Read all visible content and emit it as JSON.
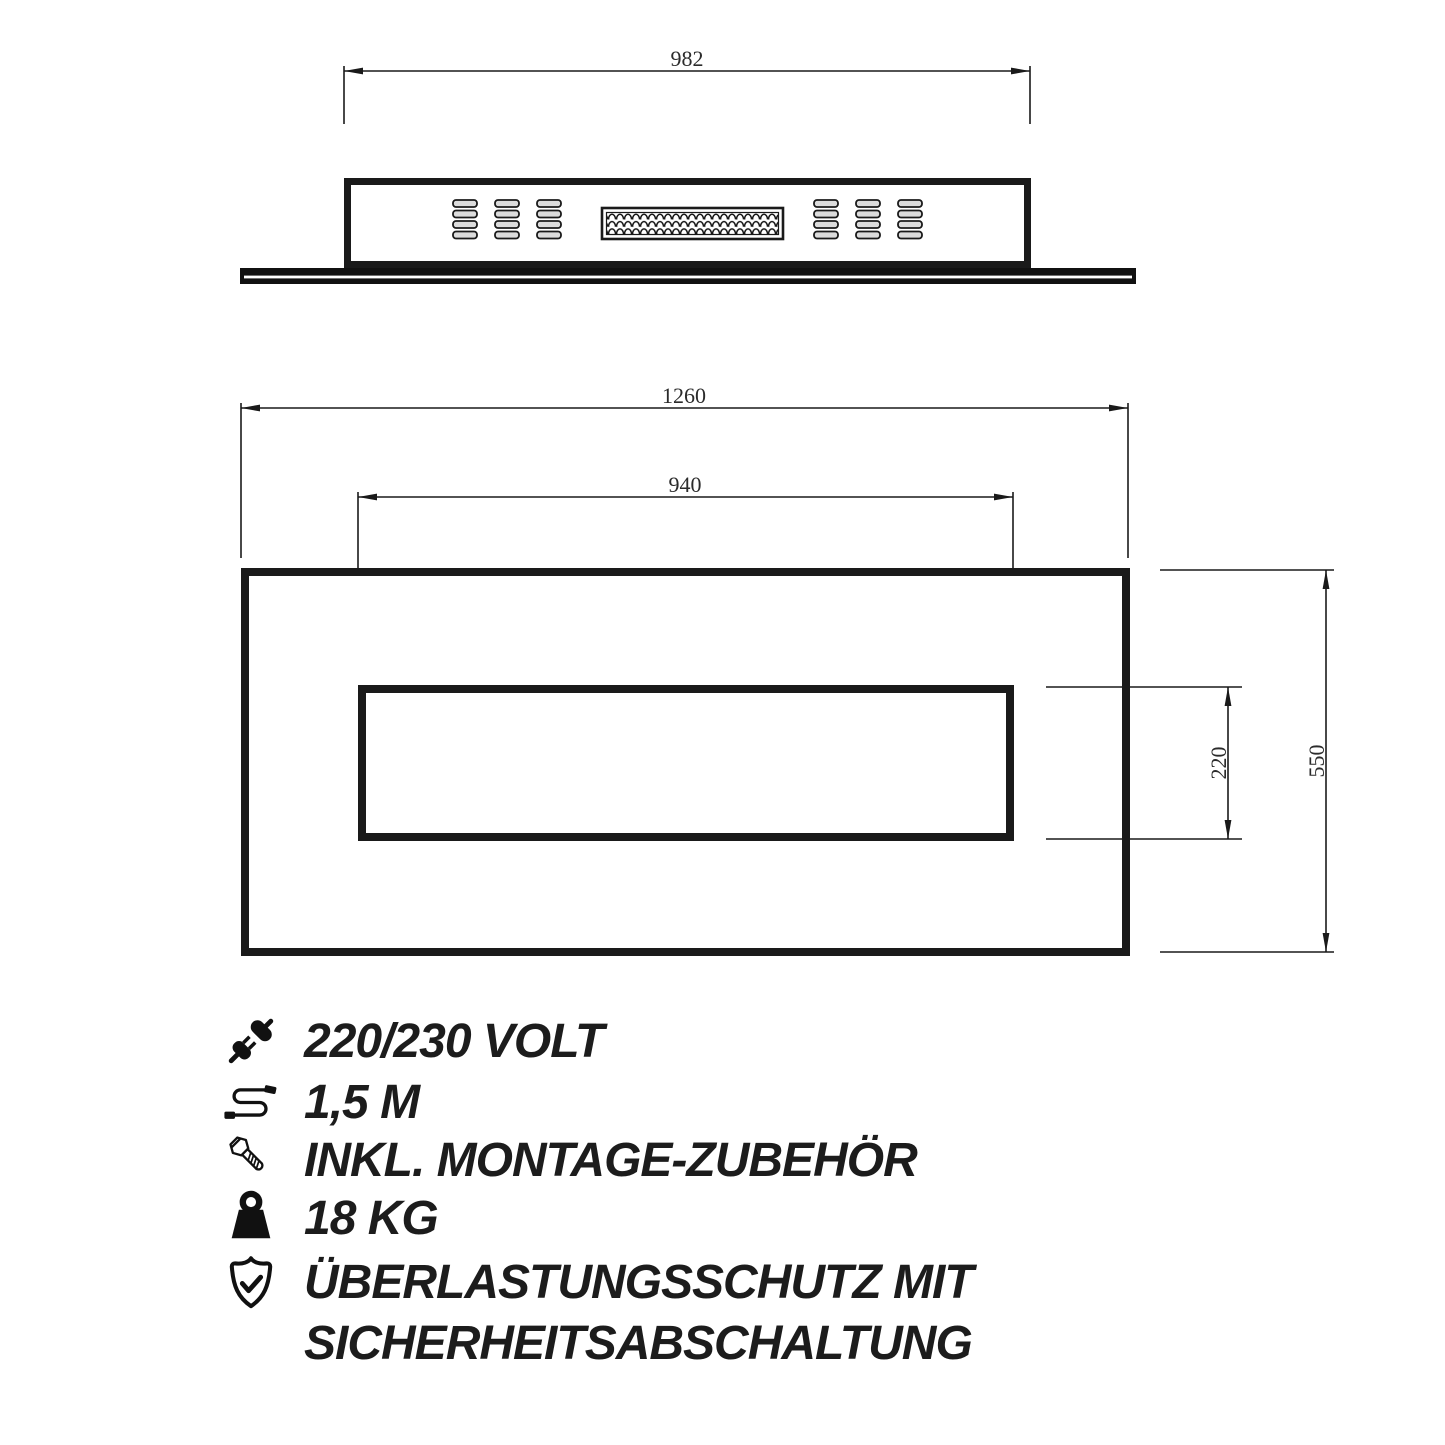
{
  "drawing": {
    "top_view": {
      "width_label": "982"
    },
    "front_view": {
      "outer_width_label": "1260",
      "inner_width_label": "940",
      "inner_height_label": "220",
      "outer_height_label": "550"
    }
  },
  "specs": {
    "items": [
      {
        "icon": "power-plug-icon",
        "label": "220/230 VOLT"
      },
      {
        "icon": "cable-icon",
        "label": "1,5 M"
      },
      {
        "icon": "screw-icon",
        "label": "INKL. MONTAGE-ZUBEHÖR"
      },
      {
        "icon": "weight-icon",
        "label": "18 KG"
      },
      {
        "icon": "shield-check-icon",
        "label": "ÜBERLASTUNGSSCHUTZ MIT",
        "label_line2": "SICHERHEITSABSCHALTUNG"
      }
    ]
  },
  "colors": {
    "line": "#1a1a1a",
    "text": "#1c1c1c",
    "vent_fill": "#dcdcdc",
    "background": "#ffffff"
  }
}
